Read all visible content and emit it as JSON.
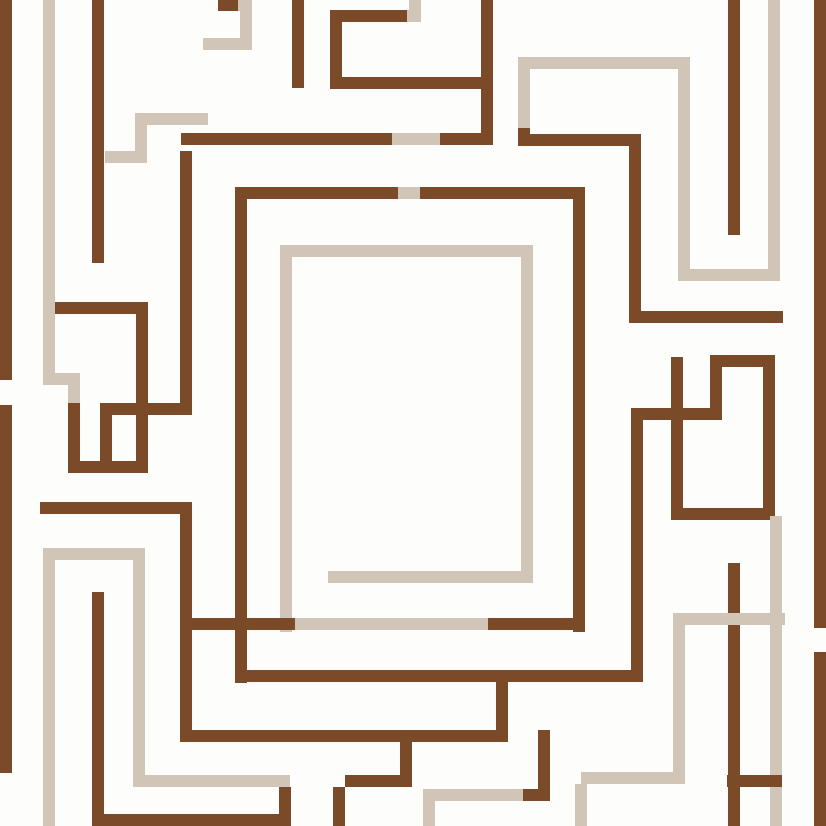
{
  "artwork": {
    "title": "Abstract geometric maze pattern",
    "description": "Greek-key style labyrinth artwork made of interlocking right-angled lines in dark brown and warm beige on an off-white background. Lines occasionally change color mid-run. A large rectangular spiral frame occupies the center.",
    "canvas": {
      "width": 826,
      "height": 826
    }
  },
  "palette": {
    "background": "#fdfdfb",
    "brown": "#7a4a29",
    "beige": "#d0c5b7"
  },
  "segments": [
    {
      "x": 0,
      "y": 0,
      "w": 12,
      "h": 380,
      "c": "brown"
    },
    {
      "x": 0,
      "y": 405,
      "w": 12,
      "h": 368,
      "c": "brown"
    },
    {
      "x": 43,
      "y": 0,
      "w": 12,
      "h": 373,
      "c": "beige"
    },
    {
      "x": 43,
      "y": 373,
      "w": 37,
      "h": 12,
      "c": "beige"
    },
    {
      "x": 68,
      "y": 385,
      "w": 12,
      "h": 18,
      "c": "beige"
    },
    {
      "x": 68,
      "y": 403,
      "w": 12,
      "h": 70,
      "c": "brown"
    },
    {
      "x": 68,
      "y": 461,
      "w": 80,
      "h": 12,
      "c": "brown"
    },
    {
      "x": 136,
      "y": 308,
      "w": 12,
      "h": 165,
      "c": "brown"
    },
    {
      "x": 55,
      "y": 302,
      "w": 93,
      "h": 12,
      "c": "brown"
    },
    {
      "x": 100,
      "y": 403,
      "w": 92,
      "h": 12,
      "c": "brown"
    },
    {
      "x": 100,
      "y": 403,
      "w": 12,
      "h": 70,
      "c": "brown"
    },
    {
      "x": 180,
      "y": 151,
      "w": 12,
      "h": 264,
      "c": "brown"
    },
    {
      "x": 40,
      "y": 502,
      "w": 152,
      "h": 12,
      "c": "brown"
    },
    {
      "x": 180,
      "y": 514,
      "w": 12,
      "h": 228,
      "c": "brown"
    },
    {
      "x": 181,
      "y": 133,
      "w": 211,
      "h": 12,
      "c": "brown"
    },
    {
      "x": 392,
      "y": 133,
      "w": 48,
      "h": 12,
      "c": "beige"
    },
    {
      "x": 440,
      "y": 133,
      "w": 53,
      "h": 12,
      "c": "brown"
    },
    {
      "x": 481,
      "y": 0,
      "w": 12,
      "h": 145,
      "c": "brown"
    },
    {
      "x": 141,
      "y": 113,
      "w": 67,
      "h": 12,
      "c": "beige"
    },
    {
      "x": 135,
      "y": 113,
      "w": 12,
      "h": 50,
      "c": "beige"
    },
    {
      "x": 105,
      "y": 151,
      "w": 42,
      "h": 12,
      "c": "beige"
    },
    {
      "x": 92,
      "y": 0,
      "w": 12,
      "h": 263,
      "c": "brown"
    },
    {
      "x": 218,
      "y": 0,
      "w": 20,
      "h": 11,
      "c": "brown"
    },
    {
      "x": 238,
      "y": 0,
      "w": 14,
      "h": 11,
      "c": "beige"
    },
    {
      "x": 240,
      "y": 11,
      "w": 12,
      "h": 39,
      "c": "beige"
    },
    {
      "x": 203,
      "y": 38,
      "w": 37,
      "h": 12,
      "c": "beige"
    },
    {
      "x": 292,
      "y": 0,
      "w": 12,
      "h": 88,
      "c": "brown"
    },
    {
      "x": 330,
      "y": 10,
      "w": 12,
      "h": 78,
      "c": "brown"
    },
    {
      "x": 330,
      "y": 10,
      "w": 77,
      "h": 12,
      "c": "brown"
    },
    {
      "x": 407,
      "y": 10,
      "w": 14,
      "h": 12,
      "c": "beige"
    },
    {
      "x": 409,
      "y": 0,
      "w": 12,
      "h": 10,
      "c": "beige"
    },
    {
      "x": 330,
      "y": 77,
      "w": 163,
      "h": 12,
      "c": "brown"
    },
    {
      "x": 235,
      "y": 187,
      "w": 12,
      "h": 496,
      "c": "brown"
    },
    {
      "x": 235,
      "y": 187,
      "w": 163,
      "h": 12,
      "c": "brown"
    },
    {
      "x": 398,
      "y": 187,
      "w": 22,
      "h": 12,
      "c": "beige"
    },
    {
      "x": 420,
      "y": 187,
      "w": 165,
      "h": 12,
      "c": "brown"
    },
    {
      "x": 573,
      "y": 187,
      "w": 12,
      "h": 445,
      "c": "brown"
    },
    {
      "x": 235,
      "y": 670,
      "w": 408,
      "h": 12,
      "c": "brown"
    },
    {
      "x": 631,
      "y": 408,
      "w": 12,
      "h": 274,
      "c": "brown"
    },
    {
      "x": 631,
      "y": 408,
      "w": 91,
      "h": 12,
      "c": "brown"
    },
    {
      "x": 710,
      "y": 367,
      "w": 12,
      "h": 53,
      "c": "brown"
    },
    {
      "x": 710,
      "y": 355,
      "w": 65,
      "h": 12,
      "c": "brown"
    },
    {
      "x": 763,
      "y": 355,
      "w": 12,
      "h": 165,
      "c": "brown"
    },
    {
      "x": 683,
      "y": 508,
      "w": 92,
      "h": 12,
      "c": "brown"
    },
    {
      "x": 671,
      "y": 357,
      "w": 12,
      "h": 163,
      "c": "brown"
    },
    {
      "x": 629,
      "y": 145,
      "w": 12,
      "h": 178,
      "c": "brown"
    },
    {
      "x": 629,
      "y": 311,
      "w": 154,
      "h": 12,
      "c": "brown"
    },
    {
      "x": 530,
      "y": 134,
      "w": 111,
      "h": 12,
      "c": "brown"
    },
    {
      "x": 518,
      "y": 57,
      "w": 12,
      "h": 71,
      "c": "beige"
    },
    {
      "x": 518,
      "y": 128,
      "w": 12,
      "h": 18,
      "c": "brown"
    },
    {
      "x": 518,
      "y": 57,
      "w": 172,
      "h": 12,
      "c": "beige"
    },
    {
      "x": 678,
      "y": 69,
      "w": 12,
      "h": 212,
      "c": "beige"
    },
    {
      "x": 690,
      "y": 269,
      "w": 90,
      "h": 12,
      "c": "beige"
    },
    {
      "x": 768,
      "y": 0,
      "w": 12,
      "h": 281,
      "c": "beige"
    },
    {
      "x": 280,
      "y": 245,
      "w": 12,
      "h": 387,
      "c": "beige"
    },
    {
      "x": 280,
      "y": 245,
      "w": 253,
      "h": 12,
      "c": "beige"
    },
    {
      "x": 521,
      "y": 257,
      "w": 12,
      "h": 326,
      "c": "beige"
    },
    {
      "x": 328,
      "y": 571,
      "w": 205,
      "h": 12,
      "c": "beige"
    },
    {
      "x": 192,
      "y": 618,
      "w": 103,
      "h": 12,
      "c": "brown"
    },
    {
      "x": 295,
      "y": 618,
      "w": 193,
      "h": 12,
      "c": "beige"
    },
    {
      "x": 488,
      "y": 618,
      "w": 97,
      "h": 12,
      "c": "brown"
    },
    {
      "x": 814,
      "y": 0,
      "w": 12,
      "h": 628,
      "c": "brown"
    },
    {
      "x": 814,
      "y": 652,
      "w": 12,
      "h": 174,
      "c": "brown"
    },
    {
      "x": 728,
      "y": 0,
      "w": 12,
      "h": 235,
      "c": "brown"
    },
    {
      "x": 728,
      "y": 563,
      "w": 12,
      "h": 263,
      "c": "brown"
    },
    {
      "x": 673,
      "y": 613,
      "w": 112,
      "h": 12,
      "c": "beige"
    },
    {
      "x": 673,
      "y": 625,
      "w": 12,
      "h": 159,
      "c": "beige"
    },
    {
      "x": 770,
      "y": 516,
      "w": 12,
      "h": 310,
      "c": "beige"
    },
    {
      "x": 581,
      "y": 772,
      "w": 104,
      "h": 12,
      "c": "beige"
    },
    {
      "x": 575,
      "y": 784,
      "w": 12,
      "h": 42,
      "c": "beige"
    },
    {
      "x": 727,
      "y": 775,
      "w": 55,
      "h": 12,
      "c": "brown"
    },
    {
      "x": 192,
      "y": 730,
      "w": 316,
      "h": 12,
      "c": "brown"
    },
    {
      "x": 496,
      "y": 682,
      "w": 12,
      "h": 60,
      "c": "brown"
    },
    {
      "x": 333,
      "y": 787,
      "w": 12,
      "h": 39,
      "c": "brown"
    },
    {
      "x": 345,
      "y": 775,
      "w": 67,
      "h": 12,
      "c": "brown"
    },
    {
      "x": 400,
      "y": 742,
      "w": 12,
      "h": 45,
      "c": "brown"
    },
    {
      "x": 423,
      "y": 789,
      "w": 100,
      "h": 12,
      "c": "beige"
    },
    {
      "x": 523,
      "y": 789,
      "w": 27,
      "h": 12,
      "c": "brown"
    },
    {
      "x": 423,
      "y": 801,
      "w": 12,
      "h": 25,
      "c": "beige"
    },
    {
      "x": 538,
      "y": 730,
      "w": 12,
      "h": 71,
      "c": "brown"
    },
    {
      "x": 43,
      "y": 548,
      "w": 12,
      "h": 278,
      "c": "beige"
    },
    {
      "x": 43,
      "y": 548,
      "w": 102,
      "h": 12,
      "c": "beige"
    },
    {
      "x": 133,
      "y": 560,
      "w": 12,
      "h": 227,
      "c": "beige"
    },
    {
      "x": 145,
      "y": 775,
      "w": 145,
      "h": 12,
      "c": "beige"
    },
    {
      "x": 279,
      "y": 787,
      "w": 12,
      "h": 39,
      "c": "brown"
    },
    {
      "x": 103,
      "y": 814,
      "w": 188,
      "h": 12,
      "c": "brown"
    },
    {
      "x": 92,
      "y": 592,
      "w": 12,
      "h": 234,
      "c": "brown"
    }
  ]
}
